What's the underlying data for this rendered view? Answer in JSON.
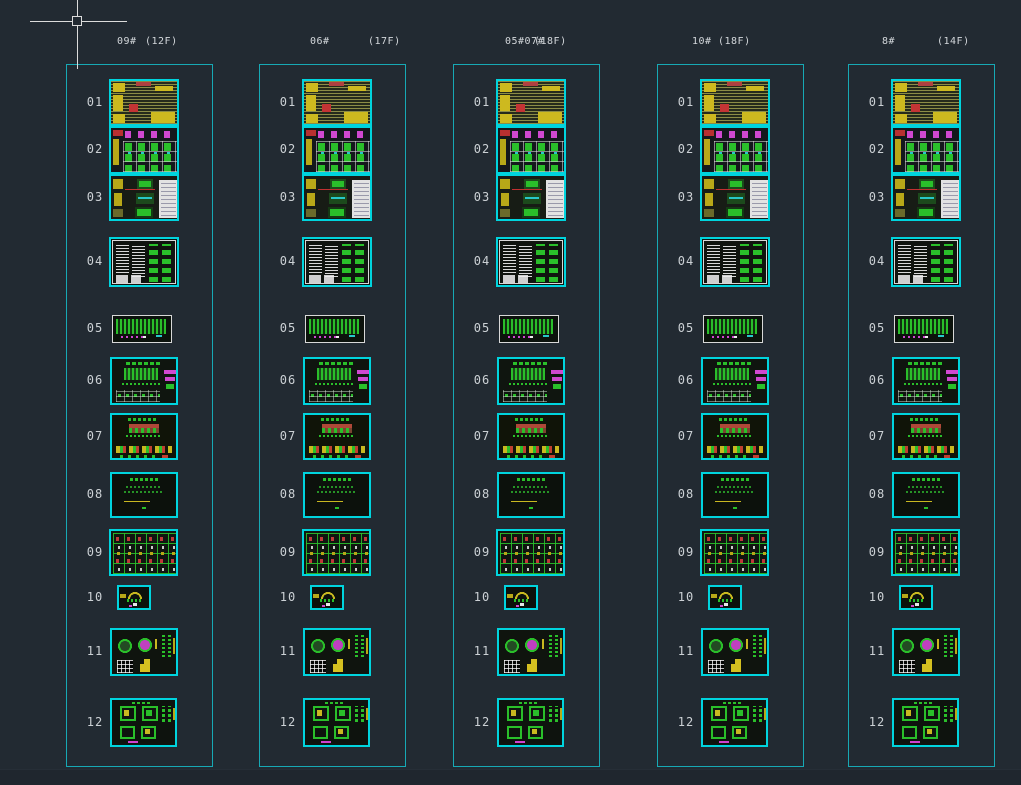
{
  "app": {
    "view": "cad-model-space-sheet-index"
  },
  "colors": {
    "background": "#222a32",
    "column_border": "#17a9b5",
    "thumb_border": "#00d4de",
    "white_sheet_border": "#d8d8d8",
    "crosshair": "#dcdcdc",
    "label_text": "#d3d7db"
  },
  "cursor": {
    "icon": "crosshair-pickbox-cursor"
  },
  "columns": [
    {
      "building": "09#",
      "floors": "(12F)",
      "rows": [
        {
          "num": "01",
          "thumb": "cover-notes-sheet"
        },
        {
          "num": "02",
          "thumb": "floor-plans-sheet"
        },
        {
          "num": "03",
          "thumb": "plans-and-table-sheet"
        },
        {
          "num": "04",
          "thumb": "notes-and-details-list-sheet"
        },
        {
          "num": "05",
          "thumb": "site-plan-small-sheet"
        },
        {
          "num": "06",
          "thumb": "elevation-sheet"
        },
        {
          "num": "07",
          "thumb": "elevation-details-sheet"
        },
        {
          "num": "08",
          "thumb": "section-notes-sheet"
        },
        {
          "num": "09",
          "thumb": "details-grid-sheet"
        },
        {
          "num": "10",
          "thumb": "small-detail-sheet"
        },
        {
          "num": "11",
          "thumb": "enlarged-plan-detail-sheet"
        },
        {
          "num": "12",
          "thumb": "stair-detail-sheet"
        }
      ]
    },
    {
      "building": "06#",
      "floors": "(17F)",
      "rows": [
        {
          "num": "01",
          "thumb": "cover-notes-sheet"
        },
        {
          "num": "02",
          "thumb": "floor-plans-sheet"
        },
        {
          "num": "03",
          "thumb": "plans-and-table-sheet"
        },
        {
          "num": "04",
          "thumb": "notes-and-details-list-sheet"
        },
        {
          "num": "05",
          "thumb": "site-plan-small-sheet"
        },
        {
          "num": "06",
          "thumb": "elevation-sheet"
        },
        {
          "num": "07",
          "thumb": "elevation-details-sheet"
        },
        {
          "num": "08",
          "thumb": "section-notes-sheet"
        },
        {
          "num": "09",
          "thumb": "details-grid-sheet"
        },
        {
          "num": "10",
          "thumb": "small-detail-sheet"
        },
        {
          "num": "11",
          "thumb": "enlarged-plan-detail-sheet"
        },
        {
          "num": "12",
          "thumb": "stair-detail-sheet"
        }
      ]
    },
    {
      "building": "05#07#",
      "floors": "(18F)",
      "rows": [
        {
          "num": "01",
          "thumb": "cover-notes-sheet"
        },
        {
          "num": "02",
          "thumb": "floor-plans-sheet"
        },
        {
          "num": "03",
          "thumb": "plans-and-table-sheet"
        },
        {
          "num": "04",
          "thumb": "notes-and-details-list-sheet"
        },
        {
          "num": "05",
          "thumb": "site-plan-small-sheet"
        },
        {
          "num": "06",
          "thumb": "elevation-sheet"
        },
        {
          "num": "07",
          "thumb": "elevation-details-sheet"
        },
        {
          "num": "08",
          "thumb": "section-notes-sheet"
        },
        {
          "num": "09",
          "thumb": "details-grid-sheet"
        },
        {
          "num": "10",
          "thumb": "small-detail-sheet"
        },
        {
          "num": "11",
          "thumb": "enlarged-plan-detail-sheet"
        },
        {
          "num": "12",
          "thumb": "stair-detail-sheet"
        }
      ]
    },
    {
      "building": "10#",
      "floors": "(18F)",
      "rows": [
        {
          "num": "01",
          "thumb": "cover-notes-sheet"
        },
        {
          "num": "02",
          "thumb": "floor-plans-sheet"
        },
        {
          "num": "03",
          "thumb": "plans-and-table-sheet"
        },
        {
          "num": "04",
          "thumb": "notes-and-details-list-sheet"
        },
        {
          "num": "05",
          "thumb": "site-plan-small-sheet"
        },
        {
          "num": "06",
          "thumb": "elevation-sheet"
        },
        {
          "num": "07",
          "thumb": "elevation-details-sheet"
        },
        {
          "num": "08",
          "thumb": "section-notes-sheet"
        },
        {
          "num": "09",
          "thumb": "details-grid-sheet"
        },
        {
          "num": "10",
          "thumb": "small-detail-sheet"
        },
        {
          "num": "11",
          "thumb": "enlarged-plan-detail-sheet"
        },
        {
          "num": "12",
          "thumb": "stair-detail-sheet"
        }
      ]
    },
    {
      "building": "8#",
      "floors": "(14F)",
      "rows": [
        {
          "num": "01",
          "thumb": "cover-notes-sheet"
        },
        {
          "num": "02",
          "thumb": "floor-plans-sheet"
        },
        {
          "num": "03",
          "thumb": "plans-and-table-sheet"
        },
        {
          "num": "04",
          "thumb": "notes-and-details-list-sheet"
        },
        {
          "num": "05",
          "thumb": "site-plan-small-sheet"
        },
        {
          "num": "06",
          "thumb": "elevation-sheet"
        },
        {
          "num": "07",
          "thumb": "elevation-details-sheet"
        },
        {
          "num": "08",
          "thumb": "section-notes-sheet"
        },
        {
          "num": "09",
          "thumb": "details-grid-sheet"
        },
        {
          "num": "10",
          "thumb": "small-detail-sheet"
        },
        {
          "num": "11",
          "thumb": "enlarged-plan-detail-sheet"
        },
        {
          "num": "12",
          "thumb": "stair-detail-sheet"
        }
      ]
    }
  ]
}
